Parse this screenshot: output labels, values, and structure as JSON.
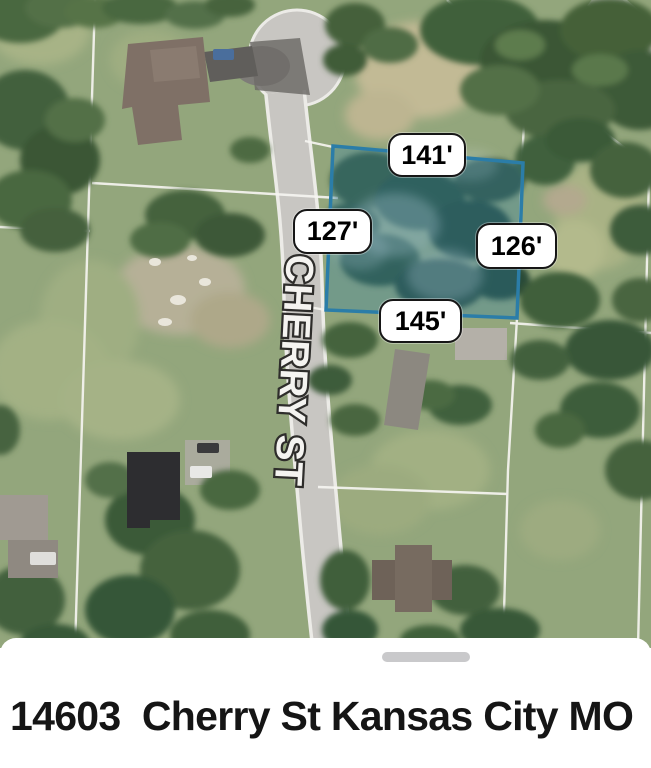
{
  "map": {
    "street_label": "CHERRY ST",
    "parcel_highlight": {
      "outline_color": "#2b7da8",
      "fill_tint": "rgba(42,125,168,0.30)",
      "dimension_labels": [
        {
          "side": "top",
          "text": "141'"
        },
        {
          "side": "left",
          "text": "127'"
        },
        {
          "side": "right",
          "text": "126'"
        },
        {
          "side": "bottom",
          "text": "145'"
        }
      ]
    }
  },
  "bottom_sheet": {
    "address_caption": "14603  Cherry St Kansas City MO"
  },
  "colors": {
    "lot_outline": "#2b7da8",
    "drag_handle": "#c9c9cb",
    "caption_text": "#151515"
  }
}
